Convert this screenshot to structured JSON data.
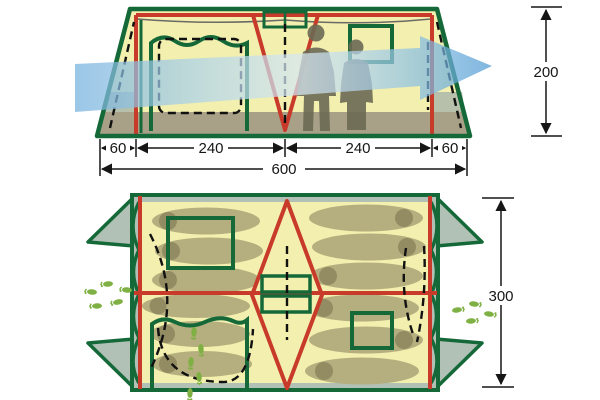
{
  "elevation": {
    "segment_labels": [
      "60",
      "240",
      "240",
      "60"
    ],
    "total_width_label": "600",
    "height_label": "200"
  },
  "floor_plan": {
    "depth_label": "300"
  },
  "colors": {
    "frame_green": "#156939",
    "pole_red": "#c83a2a",
    "canvas_yellow": "#f3efae",
    "wall_gray_green": "#b2c1b6",
    "ground_olive": "#a9a187",
    "sleeping_bag_olive": "#b5ae7e",
    "sleeping_bag_head": "#938c63",
    "wind_blue": "#4e9ad2",
    "footprint_green": "#7fb043",
    "silhouette_gray": "#6b6a54",
    "dimension_ink": "#161616"
  },
  "icons": {
    "wind": "airflow-arrow-icon",
    "footprints": "footprints-icon",
    "people": "person-silhouette",
    "bag": "sleeping-bag"
  }
}
